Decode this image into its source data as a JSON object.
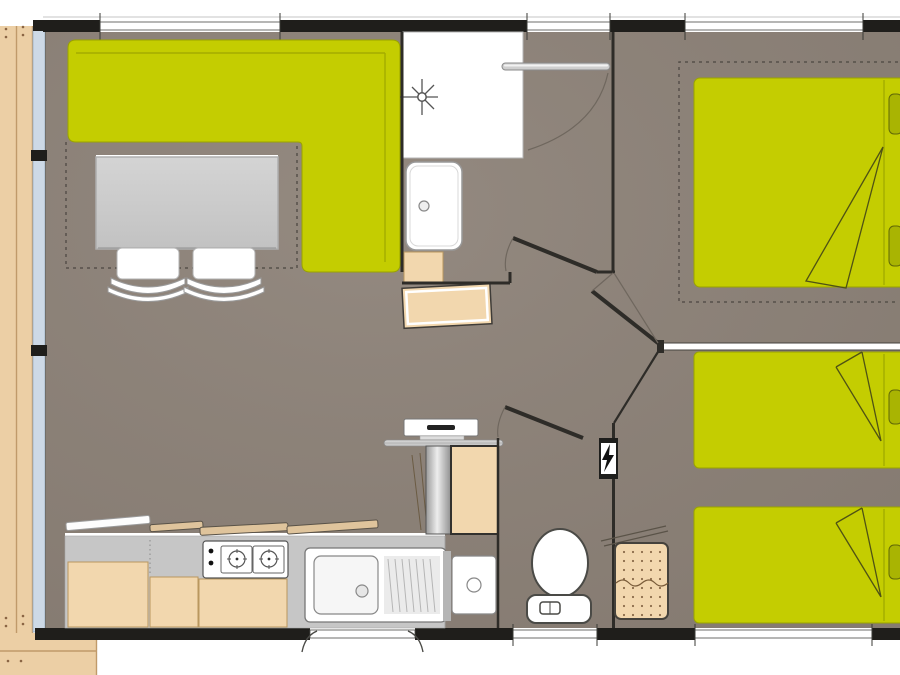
{
  "meta": {
    "title": "mobile-home-floor-plan",
    "canvas": {
      "width": 900,
      "height": 675
    }
  },
  "colors": {
    "bg": "#ffffff",
    "wall": "#1f1e1b",
    "floor": "#8c8177",
    "floor-light": "#968b80",
    "green": "#c4cd01",
    "green-edge": "#9aa300",
    "green-seam": "#a3ac00",
    "green-dark": "#4f5214",
    "pillow": "#a9b402",
    "pillow-edge": "#5f6608",
    "tan": "#f2d7ae",
    "tan-edge": "#b9975f",
    "deck": "#eccfa5",
    "deck-line": "#c09a6a",
    "deck-dot": "#8a6544",
    "glass": "#cdd9e6",
    "glass-edge": "#9ab0c4",
    "fixture": "#ffffff",
    "fixture-edge": "#6f6f6d",
    "gray-furn": "#c9c9c9",
    "counter": "#c6c6c6",
    "dash": "#56504a",
    "door": "#2e2c28",
    "arc": "#6f675e",
    "divider-edge": "#44423e"
  },
  "rooms": [
    {
      "name": "living-kitchen",
      "furniture": [
        "corner-sofa",
        "dining-table",
        "chair",
        "chair",
        "kitchen-counter",
        "stove",
        "sink",
        "fridge",
        "water-heater",
        "wall-shelf"
      ]
    },
    {
      "name": "bathroom",
      "furniture": [
        "shower-tray",
        "shower-head",
        "washbasin",
        "vanity-cabinet",
        "storage-chest",
        "clothes-rail"
      ]
    },
    {
      "name": "wc",
      "furniture": [
        "toilet",
        "hand-basin",
        "electrical-panel"
      ]
    },
    {
      "name": "bedroom-double",
      "furniture": [
        "double-bed",
        "pillow",
        "pillow"
      ]
    },
    {
      "name": "bedroom-twin",
      "furniture": [
        "single-bed",
        "single-bed",
        "pillow",
        "pillow",
        "bedside-stool"
      ]
    },
    {
      "name": "terrace",
      "furniture": [
        "deck-boards"
      ]
    }
  ]
}
